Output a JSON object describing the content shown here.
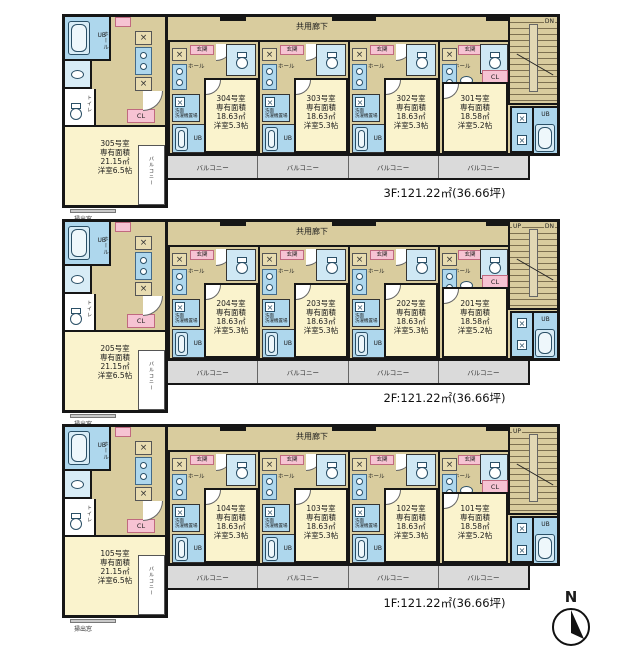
{
  "colors": {
    "wall": "#161616",
    "room_yellow": "#faf3cd",
    "corridor_tan": "#d9cc9e",
    "wet_area_blue": "#aed7ed",
    "label_pink": "#f6c3d3",
    "balcony_gray": "#dadada"
  },
  "labels": {
    "corridor": "共用廊下",
    "balcony": "バルコニー",
    "ub": "UB",
    "toilet": "トイレ",
    "hall": "ホール",
    "entrance": "玄関",
    "closet": "CL",
    "washroom": "洗面",
    "washer": "洗濯機置場",
    "window_note": "掃出窓",
    "north": "N"
  },
  "floors": [
    {
      "id": "3F",
      "summary": "3F:121.22㎡(36.66坪)",
      "stairs_up": "",
      "stairs_dn": "DN",
      "units": [
        {
          "name": "305号室",
          "l1": "専有面積",
          "l2": "21.15㎡",
          "l3": "洋室6.5帖"
        },
        {
          "name": "304号室",
          "l1": "専有面積",
          "l2": "18.63㎡",
          "l3": "洋室5.3帖"
        },
        {
          "name": "303号室",
          "l1": "専有面積",
          "l2": "18.63㎡",
          "l3": "洋室5.3帖"
        },
        {
          "name": "302号室",
          "l1": "専有面積",
          "l2": "18.63㎡",
          "l3": "洋室5.3帖"
        },
        {
          "name": "301号室",
          "l1": "専有面積",
          "l2": "18.58㎡",
          "l3": "洋室5.2帖"
        }
      ]
    },
    {
      "id": "2F",
      "summary": "2F:121.22㎡(36.66坪)",
      "stairs_up": "UP",
      "stairs_dn": "DN",
      "units": [
        {
          "name": "205号室",
          "l1": "専有面積",
          "l2": "21.15㎡",
          "l3": "洋室6.5帖"
        },
        {
          "name": "204号室",
          "l1": "専有面積",
          "l2": "18.63㎡",
          "l3": "洋室5.3帖"
        },
        {
          "name": "203号室",
          "l1": "専有面積",
          "l2": "18.63㎡",
          "l3": "洋室5.3帖"
        },
        {
          "name": "202号室",
          "l1": "専有面積",
          "l2": "18.63㎡",
          "l3": "洋室5.3帖"
        },
        {
          "name": "201号室",
          "l1": "専有面積",
          "l2": "18.58㎡",
          "l3": "洋室5.2帖"
        }
      ]
    },
    {
      "id": "1F",
      "summary": "1F:121.22㎡(36.66坪)",
      "stairs_up": "UP",
      "stairs_dn": "",
      "units": [
        {
          "name": "105号室",
          "l1": "専有面積",
          "l2": "21.15㎡",
          "l3": "洋室6.5帖"
        },
        {
          "name": "104号室",
          "l1": "専有面積",
          "l2": "18.63㎡",
          "l3": "洋室5.3帖"
        },
        {
          "name": "103号室",
          "l1": "専有面積",
          "l2": "18.63㎡",
          "l3": "洋室5.3帖"
        },
        {
          "name": "102号室",
          "l1": "専有面積",
          "l2": "18.63㎡",
          "l3": "洋室5.3帖"
        },
        {
          "name": "101号室",
          "l1": "専有面積",
          "l2": "18.58㎡",
          "l3": "洋室5.2帖"
        }
      ]
    }
  ]
}
